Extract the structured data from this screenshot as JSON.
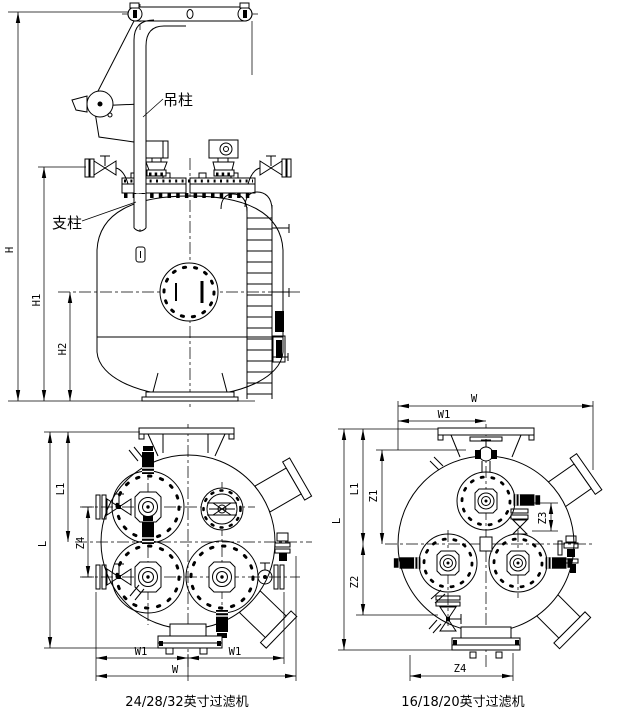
{
  "drawing": {
    "background_color": "#ffffff",
    "line_color": "#000000"
  },
  "elevation": {
    "labels": {
      "lifting_column": "吊柱",
      "support_column": "支柱"
    },
    "dims": {
      "h": "H",
      "h1": "H1",
      "h2": "H2"
    }
  },
  "plan_large": {
    "caption": "24/28/32英寸过滤机",
    "dims": {
      "l": "L",
      "l1": "L1",
      "z4": "Z4",
      "w": "W",
      "w1_left": "W1",
      "w1_right": "W1"
    }
  },
  "plan_small": {
    "caption": "16/18/20英寸过滤机",
    "dims": {
      "w": "W",
      "w1": "W1",
      "l": "L",
      "l1": "L1",
      "z1": "Z1",
      "z2": "Z2",
      "z3": "Z3",
      "z4": "Z4"
    }
  }
}
